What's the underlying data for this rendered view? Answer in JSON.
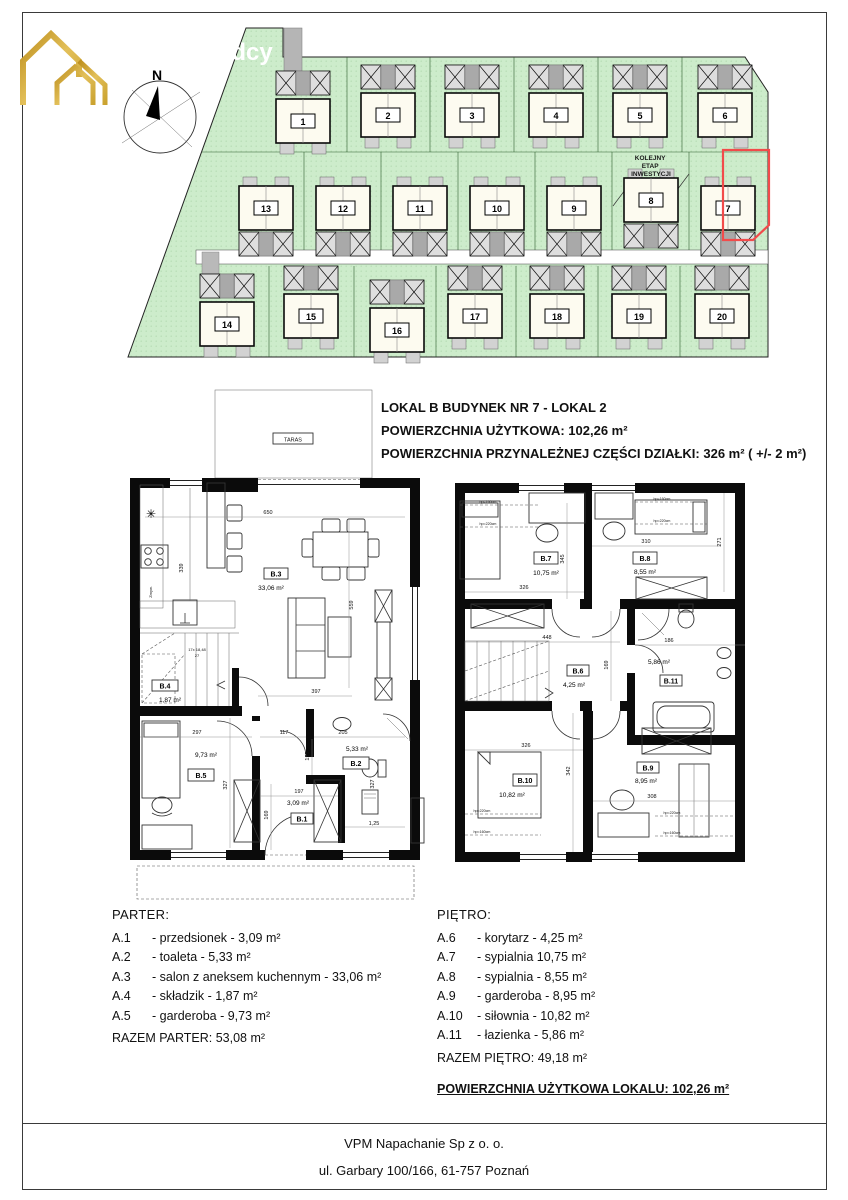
{
  "watermark": "dcy",
  "compass": {
    "north_label": "N"
  },
  "siteplan": {
    "note_lines": [
      "KOLEJNY",
      "ETAP",
      "INWESTYCJI"
    ],
    "highlight_color": "#f24b4b",
    "green_color": "#cdeccb",
    "houses": [
      {
        "number": "1"
      },
      {
        "number": "2"
      },
      {
        "number": "3"
      },
      {
        "number": "4"
      },
      {
        "number": "5"
      },
      {
        "number": "6"
      },
      {
        "number": "7"
      },
      {
        "number": "8"
      },
      {
        "number": "9"
      },
      {
        "number": "10"
      },
      {
        "number": "11"
      },
      {
        "number": "12"
      },
      {
        "number": "13"
      },
      {
        "number": "14"
      },
      {
        "number": "15"
      },
      {
        "number": "16"
      },
      {
        "number": "17"
      },
      {
        "number": "18"
      },
      {
        "number": "19"
      },
      {
        "number": "20"
      }
    ]
  },
  "info": {
    "line1": "LOKAL B BUDYNEK NR 7 - LOKAL 2",
    "line2": "POWIERZCHNIA UŻYTKOWA: 102,26 m²",
    "line3": "POWIERZCHNIA PRZYNALEŻNEJ CZĘŚCI DZIAŁKI: 326 m² ( +/- 2 m²)"
  },
  "plans": {
    "taras_label": "TARAS",
    "parter": {
      "rooms": {
        "b1": {
          "id": "B.1",
          "area": "3,09 m²"
        },
        "b2": {
          "id": "B.2",
          "area": "5,33 m²"
        },
        "b3": {
          "id": "B.3",
          "area": "33,06 m²"
        },
        "b4": {
          "id": "B.4",
          "area": "1,87 m²"
        },
        "b5": {
          "id": "B.5",
          "area": "9,73 m²"
        }
      },
      "labels": {
        "zmyw": "Zmyw.",
        "stairs1": "17x 18,48",
        "stairs2": "27"
      },
      "dims": {
        "top": "650",
        "kitchen": "339",
        "right": "559",
        "living": "397",
        "b5w": "297",
        "hall": "117",
        "b2w": "205",
        "h155": "155",
        "b5h": "327",
        "b1w": "197",
        "b1h": "169",
        "b2h": "327",
        "w125": "1,25"
      }
    },
    "pietro": {
      "rooms": {
        "b6": {
          "id": "B.6",
          "area": "4,25 m²"
        },
        "b7": {
          "id": "B.7",
          "area": "10,75 m²"
        },
        "b8": {
          "id": "B.8",
          "area": "8,55 m²"
        },
        "b9": {
          "id": "B.9",
          "area": "8,95 m²"
        },
        "b10": {
          "id": "B.10",
          "area": "10,82 m²"
        },
        "b11": {
          "id": "B.11",
          "area": "5,86 m²"
        }
      },
      "dims": {
        "b8w": "310",
        "b8h": "271",
        "mid": "345",
        "b7w": "326",
        "corr": "448",
        "bath": "186",
        "corrh": "169",
        "b10w": "326",
        "midb": "342",
        "b9w": "308"
      },
      "hp": {
        "hp160": "hp=160cm",
        "hp220": "hp=220cm"
      }
    }
  },
  "lists": {
    "parter": {
      "title": "PARTER:",
      "items": [
        {
          "code": "A.1",
          "desc": "- przedsionek - 3,09 m²"
        },
        {
          "code": "A.2",
          "desc": "- toaleta - 5,33 m²"
        },
        {
          "code": "A.3",
          "desc": "- salon z aneksem kuchennym - 33,06 m²"
        },
        {
          "code": "A.4",
          "desc": "- składzik - 1,87 m²"
        },
        {
          "code": "A.5",
          "desc": "- garderoba - 9,73 m²"
        }
      ],
      "total": "RAZEM PARTER: 53,08 m²"
    },
    "pietro": {
      "title": "PIĘTRO:",
      "items": [
        {
          "code": "A.6",
          "desc": "- korytarz - 4,25 m²"
        },
        {
          "code": "A.7",
          "desc": "- sypialnia 10,75 m²"
        },
        {
          "code": "A.8",
          "desc": "- sypialnia  - 8,55 m²"
        },
        {
          "code": "A.9",
          "desc": "- garderoba - 8,95 m²"
        },
        {
          "code": "A.10",
          "desc": "- siłownia - 10,82 m²"
        },
        {
          "code": "A.11",
          "desc": "- łazienka - 5,86 m²"
        }
      ],
      "total": "RAZEM PIĘTRO: 49,18 m²"
    },
    "grand_total": "POWIERZCHNIA UŻYTKOWA LOKALU: 102,26 m²"
  },
  "footer": {
    "company": "VPM Napachanie Sp z o. o.",
    "address": "ul. Garbary 100/166, 61-757 Poznań"
  }
}
